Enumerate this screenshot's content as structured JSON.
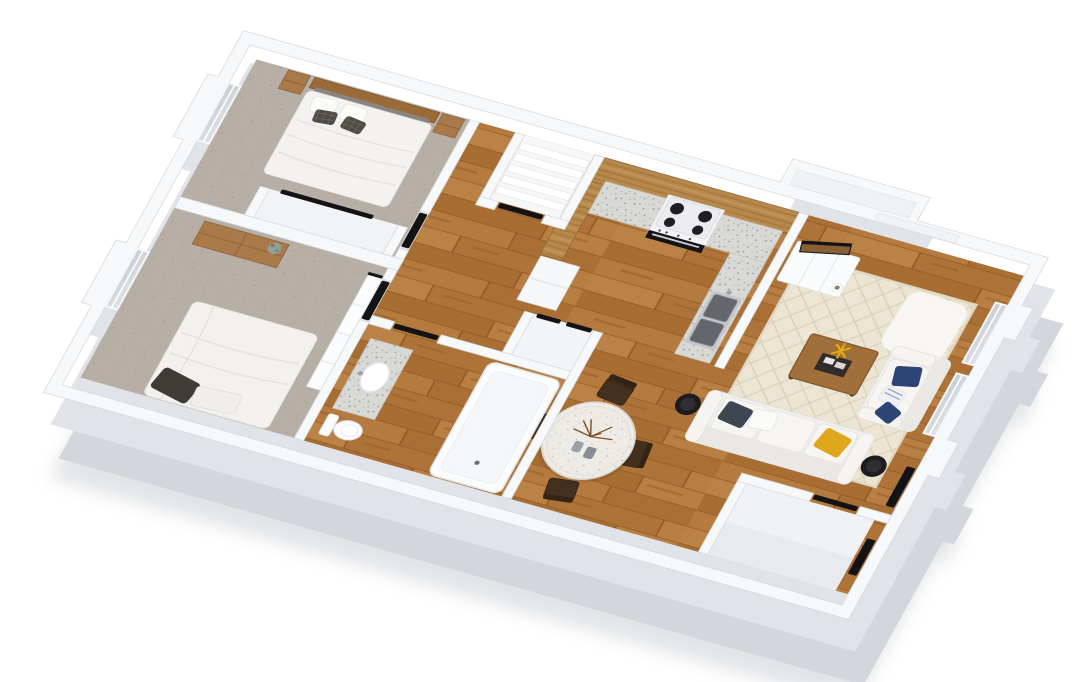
{
  "scene": {
    "type": "3d-floor-plan-render",
    "description": "3D rendered floor plan of a two-bedroom apartment viewed from above at an angle, white walls, hardwood and carpet floors, fully furnished",
    "rooms": [
      {
        "name": "bedroom-1",
        "floor": "carpet",
        "furniture": [
          "double-bed-wood-headboard",
          "nightstand-left",
          "nightstand-right",
          "reach-in-closet",
          "west-window"
        ]
      },
      {
        "name": "bedroom-2",
        "floor": "carpet",
        "furniture": [
          "bed-white-duvet",
          "wood-dresser",
          "plant",
          "closet-panel-doors",
          "west-window"
        ]
      },
      {
        "name": "hallway",
        "floor": "hardwood",
        "furniture": [
          "linen-closet-shelves",
          "hall-closet"
        ]
      },
      {
        "name": "bathroom",
        "floor": "hardwood",
        "furniture": [
          "bathtub",
          "toilet",
          "granite-vanity-sink"
        ]
      },
      {
        "name": "kitchen",
        "floor": "hardwood",
        "furniture": [
          "u-shaped-granite-counter",
          "wood-upper-cabinets",
          "range-oven",
          "double-stainless-sink",
          "refrigerator"
        ]
      },
      {
        "name": "living-room",
        "floor": "hardwood",
        "furniture": [
          "three-seat-sofa",
          "loveseat",
          "wood-coffee-table",
          "lattice-area-rug",
          "tv-console",
          "tv",
          "side-table-west",
          "side-table-east",
          "wall-niche",
          "east-windows"
        ]
      },
      {
        "name": "dining-area",
        "floor": "hardwood",
        "furniture": [
          "round-terrazzo-table",
          "dining-chair-north",
          "dining-chair-south",
          "dining-chair-west",
          "dining-chair-east",
          "branch-centerpiece",
          "two-vases"
        ]
      },
      {
        "name": "entry-vestibule",
        "floor": "light-tile",
        "furniture": [
          "entry-door",
          "interior-door"
        ]
      }
    ],
    "door_seal_count": 10,
    "window_count": 4
  },
  "colors": {
    "background": "#ffffff",
    "wall": "#f7f8f9",
    "wall_face_shadow": "#d3d7dd",
    "wall_face_mid": "#e0e3e8",
    "hardwood": "#b0763b",
    "carpet": "#b6aea4",
    "cabinet_wood": "#b6884c",
    "granite": "#d8d8d5",
    "rug": "#ece5d3",
    "sofa": "#f1f0ed",
    "pillow_navy": "#2c4576",
    "pillow_yellow": "#e0a71c",
    "pillow_dark": "#3f4652",
    "chair_wood": "#43301f",
    "door_seal": "#131316",
    "tub_white": "#fbfcfd",
    "window_glass": "#ccd5dc",
    "table_top": "#edebe6",
    "headboard_wood": "#9a6b38",
    "nightstand_wood": "#a9794a"
  }
}
